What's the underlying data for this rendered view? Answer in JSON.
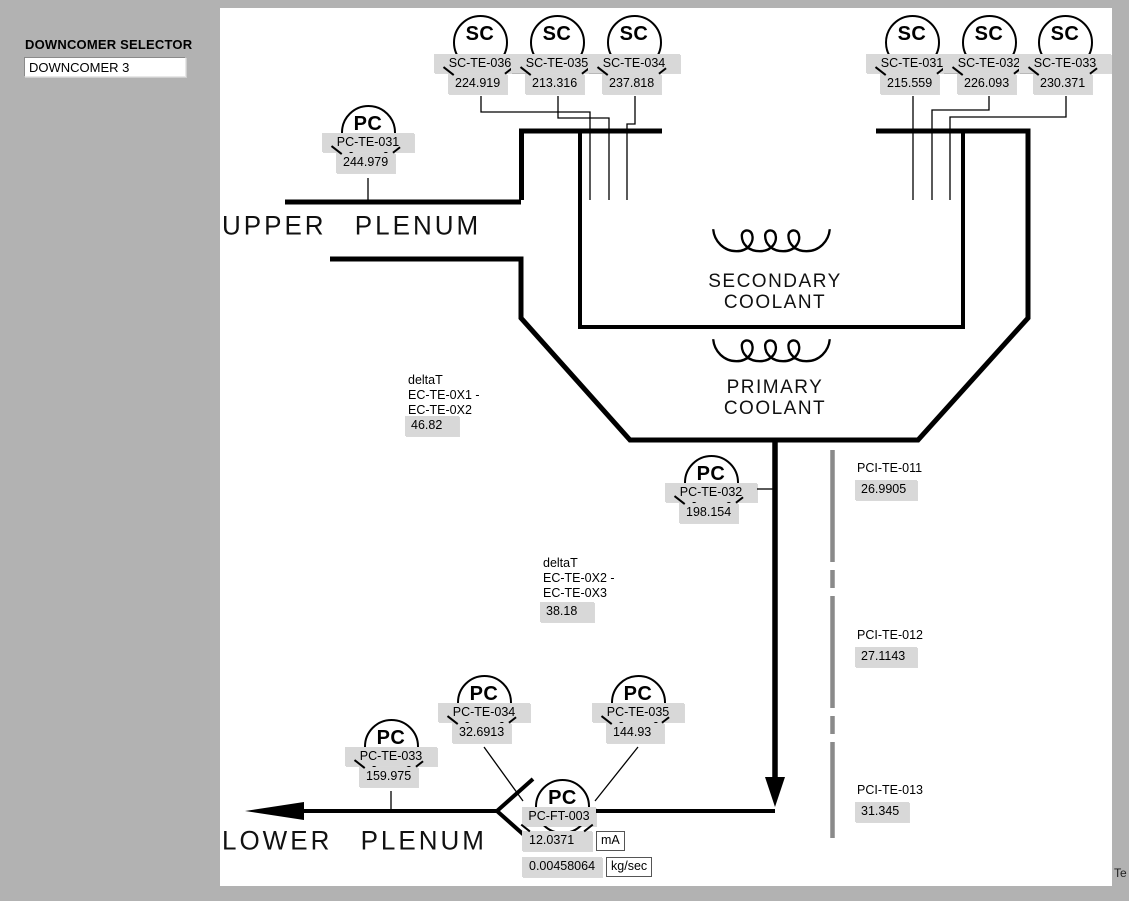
{
  "window": {
    "clipped_text": "Te"
  },
  "sidebar": {
    "selector_label": "DOWNCOMER SELECTOR",
    "selector_value": "DOWNCOMER 3"
  },
  "colors": {
    "background_gray": "#b2b2b2",
    "canvas_white": "#ffffff",
    "indicator_gray": "#d8d8d8",
    "line_black": "#000000",
    "dashed_bar_gray": "#8a8a8a"
  },
  "diagram": {
    "upper_plenum_label": "UPPER PLENUM",
    "lower_plenum_label": "LOWER PLENUM",
    "secondary_coolant": {
      "line1": "SECONDARY",
      "line2": "COOLANT"
    },
    "primary_coolant": {
      "line1": "PRIMARY",
      "line2": "COOLANT"
    },
    "sensors": [
      {
        "kind": "SC",
        "tag": "SC-TE-036",
        "value": "224.919"
      },
      {
        "kind": "SC",
        "tag": "SC-TE-035",
        "value": "213.316"
      },
      {
        "kind": "SC",
        "tag": "SC-TE-034",
        "value": "237.818"
      },
      {
        "kind": "SC",
        "tag": "SC-TE-031",
        "value": "215.559"
      },
      {
        "kind": "SC",
        "tag": "SC-TE-032",
        "value": "226.093"
      },
      {
        "kind": "SC",
        "tag": "SC-TE-033",
        "value": "230.371"
      },
      {
        "kind": "PC",
        "tag": "PC-TE-031",
        "value": "244.979"
      },
      {
        "kind": "PC",
        "tag": "PC-TE-032",
        "value": "198.154"
      },
      {
        "kind": "PC",
        "tag": "PC-TE-034",
        "value": "32.6913"
      },
      {
        "kind": "PC",
        "tag": "PC-TE-035",
        "value": "144.93"
      },
      {
        "kind": "PC",
        "tag": "PC-TE-033",
        "value": "159.975"
      }
    ],
    "flow_sensor": {
      "kind": "PC",
      "tag": "PC-FT-003",
      "current_value": "12.0371",
      "current_unit": "mA",
      "flow_value": "0.00458064",
      "flow_unit": "kg/sec"
    },
    "delta_t": [
      {
        "lines": [
          "deltaT",
          "EC-TE-0X1 -",
          "EC-TE-0X2"
        ],
        "value": "46.82"
      },
      {
        "lines": [
          "deltaT",
          "EC-TE-0X2 -",
          "EC-TE-0X3"
        ],
        "value": "38.18"
      }
    ],
    "pci": [
      {
        "tag": "PCI-TE-011",
        "value": "26.9905"
      },
      {
        "tag": "PCI-TE-012",
        "value": "27.1143"
      },
      {
        "tag": "PCI-TE-013",
        "value": "31.345"
      }
    ]
  }
}
